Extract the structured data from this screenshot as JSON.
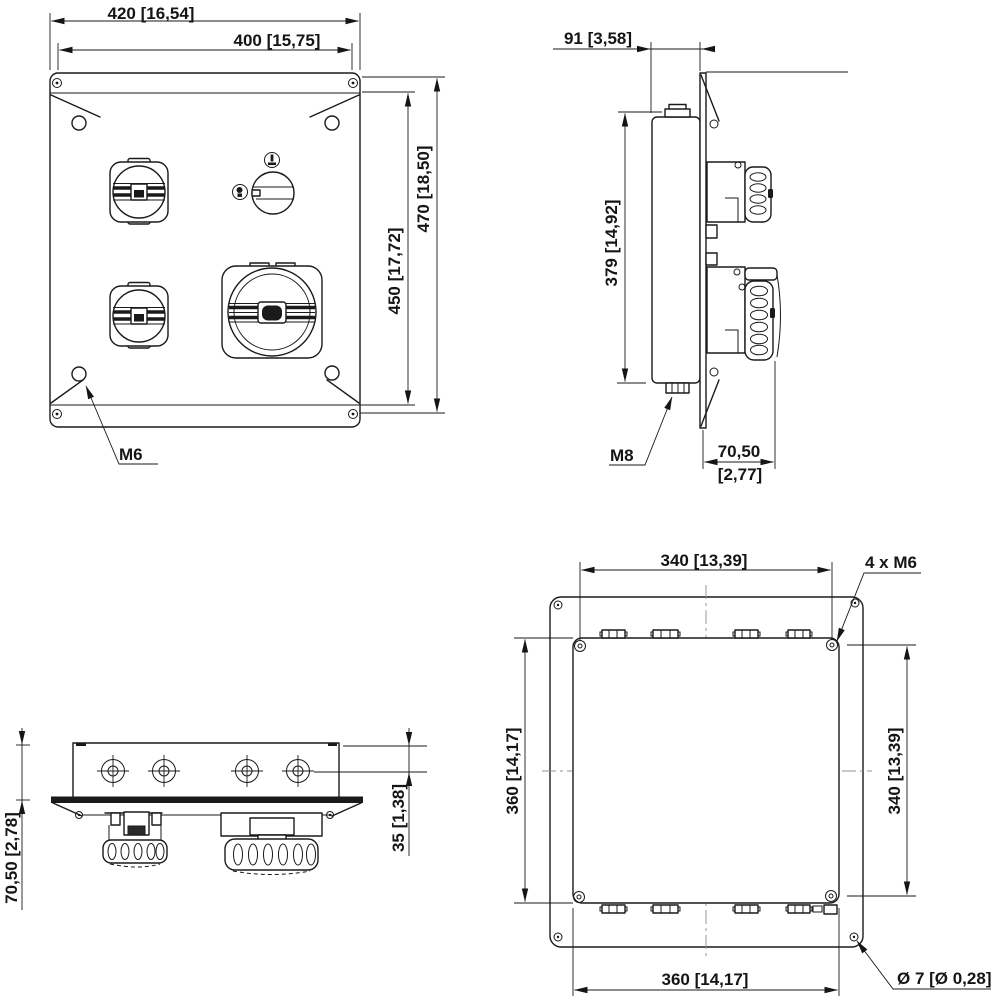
{
  "drawing": {
    "front": {
      "dim_width_outer": "420 [16,54]",
      "dim_width_inner": "400 [15,75]",
      "dim_height_inner": "450 [17,72]",
      "dim_height_outer": "470 [18,50]",
      "label_screw": "M6"
    },
    "side": {
      "dim_depth": "91 [3,58]",
      "dim_height": "379 [14,92]",
      "label_stud": "M8",
      "dim_protrusion_mm": "70,50",
      "dim_protrusion_inch": "[2,77]"
    },
    "bottom": {
      "dim_depth": "70,50 [2,78]",
      "dim_offset": "35 [1,38]"
    },
    "rear": {
      "dim_top": "340 [13,39]",
      "label_screws": "4 x M6",
      "dim_left": "360 [14,17]",
      "dim_right": "340 [13,39]",
      "dim_bottom": "360 [14,17]",
      "label_hole": "Ø 7 [Ø 0,28]"
    },
    "colors": {
      "line": "#1a1a1a",
      "background": "#ffffff",
      "centerline": "#909090"
    }
  }
}
